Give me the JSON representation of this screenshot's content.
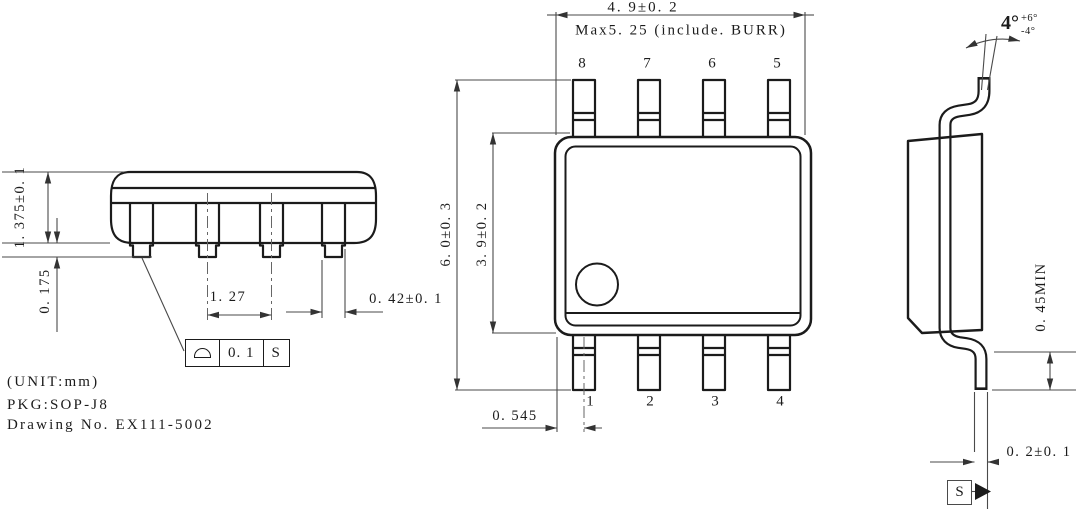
{
  "notes": {
    "unit": "(UNIT:mm)",
    "package": "PKG:SOP-J8",
    "drawing_no": "Drawing No. EX111-5002"
  },
  "front_view": {
    "dim_body_height": "1. 375±0. 1",
    "dim_standoff": "0. 175",
    "dim_lead_pitch": "1. 27",
    "dim_lead_width": "0. 42±0. 1",
    "tolerance_frame": {
      "symbol_name": "profile-of-a-surface",
      "value": "0. 1",
      "datum": "S"
    }
  },
  "top_view": {
    "dim_body_width": "4. 9±0. 2",
    "dim_max_width_burr": "Max5. 25 (include. BURR)",
    "dim_overall_length": "6. 0±0. 3",
    "dim_body_length": "3. 9±0. 2",
    "dim_edge_to_pin1": "0. 545",
    "pins_top": [
      "8",
      "7",
      "6",
      "5"
    ],
    "pins_bottom": [
      "1",
      "2",
      "3",
      "4"
    ]
  },
  "side_view": {
    "angle_base": "4°",
    "angle_plus": "+6°",
    "angle_minus": "-4°",
    "dim_lead_length_min": "0. 45MIN",
    "dim_lead_thickness": "0. 2±0. 1",
    "datum": "S"
  }
}
